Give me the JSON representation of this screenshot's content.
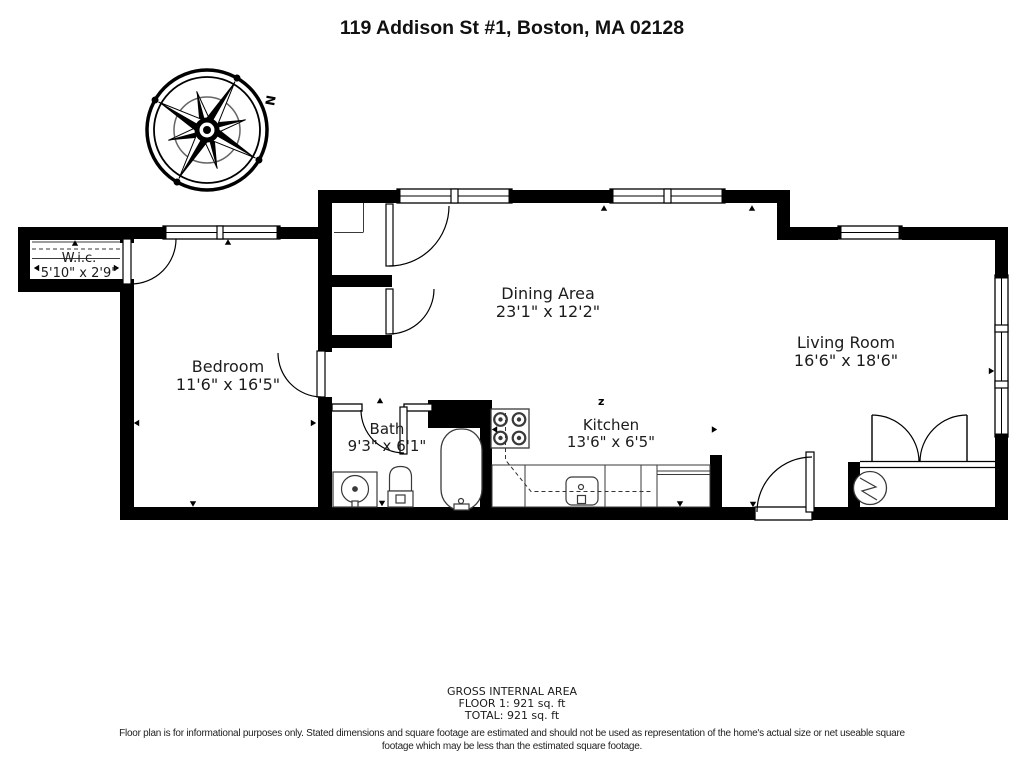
{
  "title": "119 Addison St #1, Boston, MA 02128",
  "compass": {
    "north_label": "N"
  },
  "rooms": {
    "wic": {
      "name": "W.i.c.",
      "dims": "5'10\" x 2'9\""
    },
    "bedroom": {
      "name": "Bedroom",
      "dims": "11'6\" x 16'5\""
    },
    "dining": {
      "name": "Dining Area",
      "dims": "23'1\" x 12'2\""
    },
    "kitchen": {
      "name": "Kitchen",
      "dims": "13'6\" x 6'5\""
    },
    "bath": {
      "name": "Bath",
      "dims": "9'3\" x 6'1\""
    },
    "living": {
      "name": "Living Room",
      "dims": "16'6\" x 18'6\""
    }
  },
  "symbols": {
    "switch_label": "z"
  },
  "area_summary": {
    "heading": "GROSS INTERNAL AREA",
    "floor_line": "FLOOR 1: 921 sq. ft",
    "total_line": "TOTAL: 921 sq. ft"
  },
  "disclaimer": "Floor plan is for informational purposes only. Stated dimensions and square footage are estimated and should not be used as representation of the home's actual size or net useable square footage which may be less than the estimated square footage.",
  "colors": {
    "walls": "#000000",
    "background": "#ffffff",
    "text": "#1a1a1a"
  }
}
